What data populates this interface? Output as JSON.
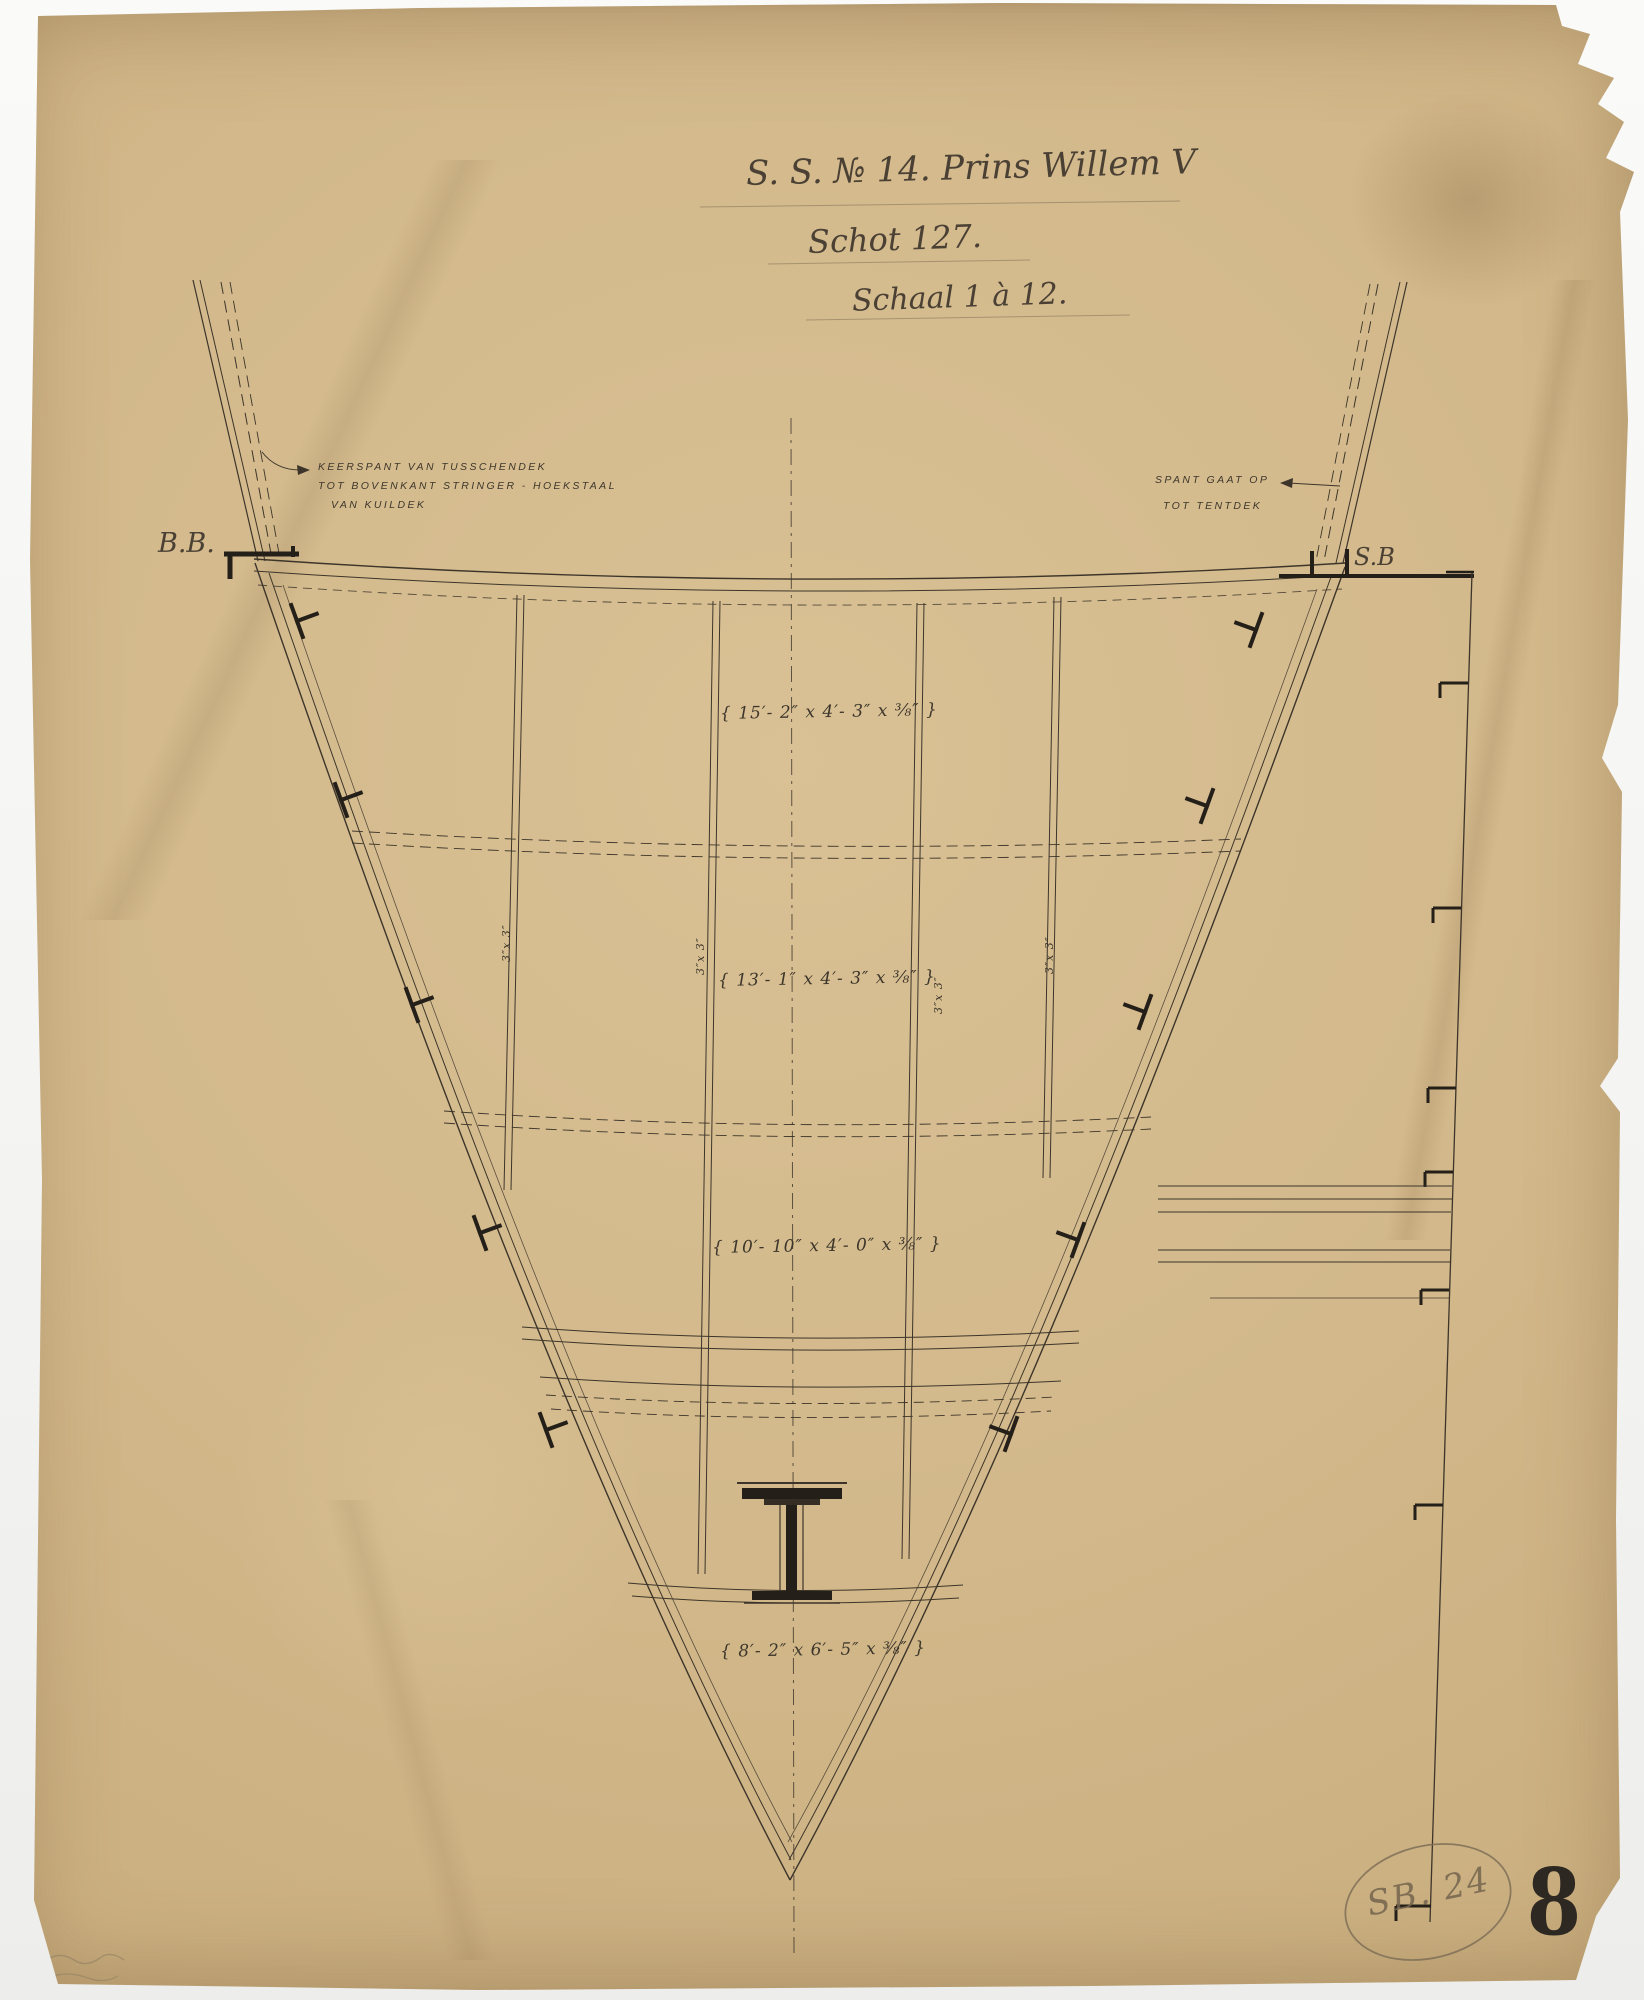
{
  "sheet": {
    "title_line1": "S. S. № 14. Prins Willem V",
    "title_line2": "Schot 127.",
    "title_line3": "Schaal 1 à 12.",
    "annotation_left": {
      "line1": "KEERSPANT VAN TUSSCHENDEK",
      "line2": "TOT BOVENKANT STRINGER - HOEKSTAAL",
      "line3": "VAN KUILDEK"
    },
    "annotation_right": {
      "line1": "SPANT GAAT OP",
      "line2": "TOT TENTDEK"
    },
    "side_labels": {
      "port": "B.B.",
      "starboard": "S.B"
    },
    "plate_dimensions": {
      "upper": "{ 15′- 2″ x 4′- 3″ x ⅜″ }",
      "second": "{ 13′- 1″ x 4′- 3″ x ⅜″ }",
      "third": "{ 10′- 10″ x 4′- 0″ x ⅜″ }",
      "lower": "{ 8′- 2″ x 6′- 5″ x ⅜″ }"
    },
    "stiffener_label": "3″x 3″",
    "archive": {
      "oval_note": "SB. 24",
      "stamp_number": "8"
    },
    "colors": {
      "paper": "#d2b88a",
      "ink": "#3d352a",
      "heavy_ink": "#241f18",
      "pencil": "#74654e"
    }
  }
}
